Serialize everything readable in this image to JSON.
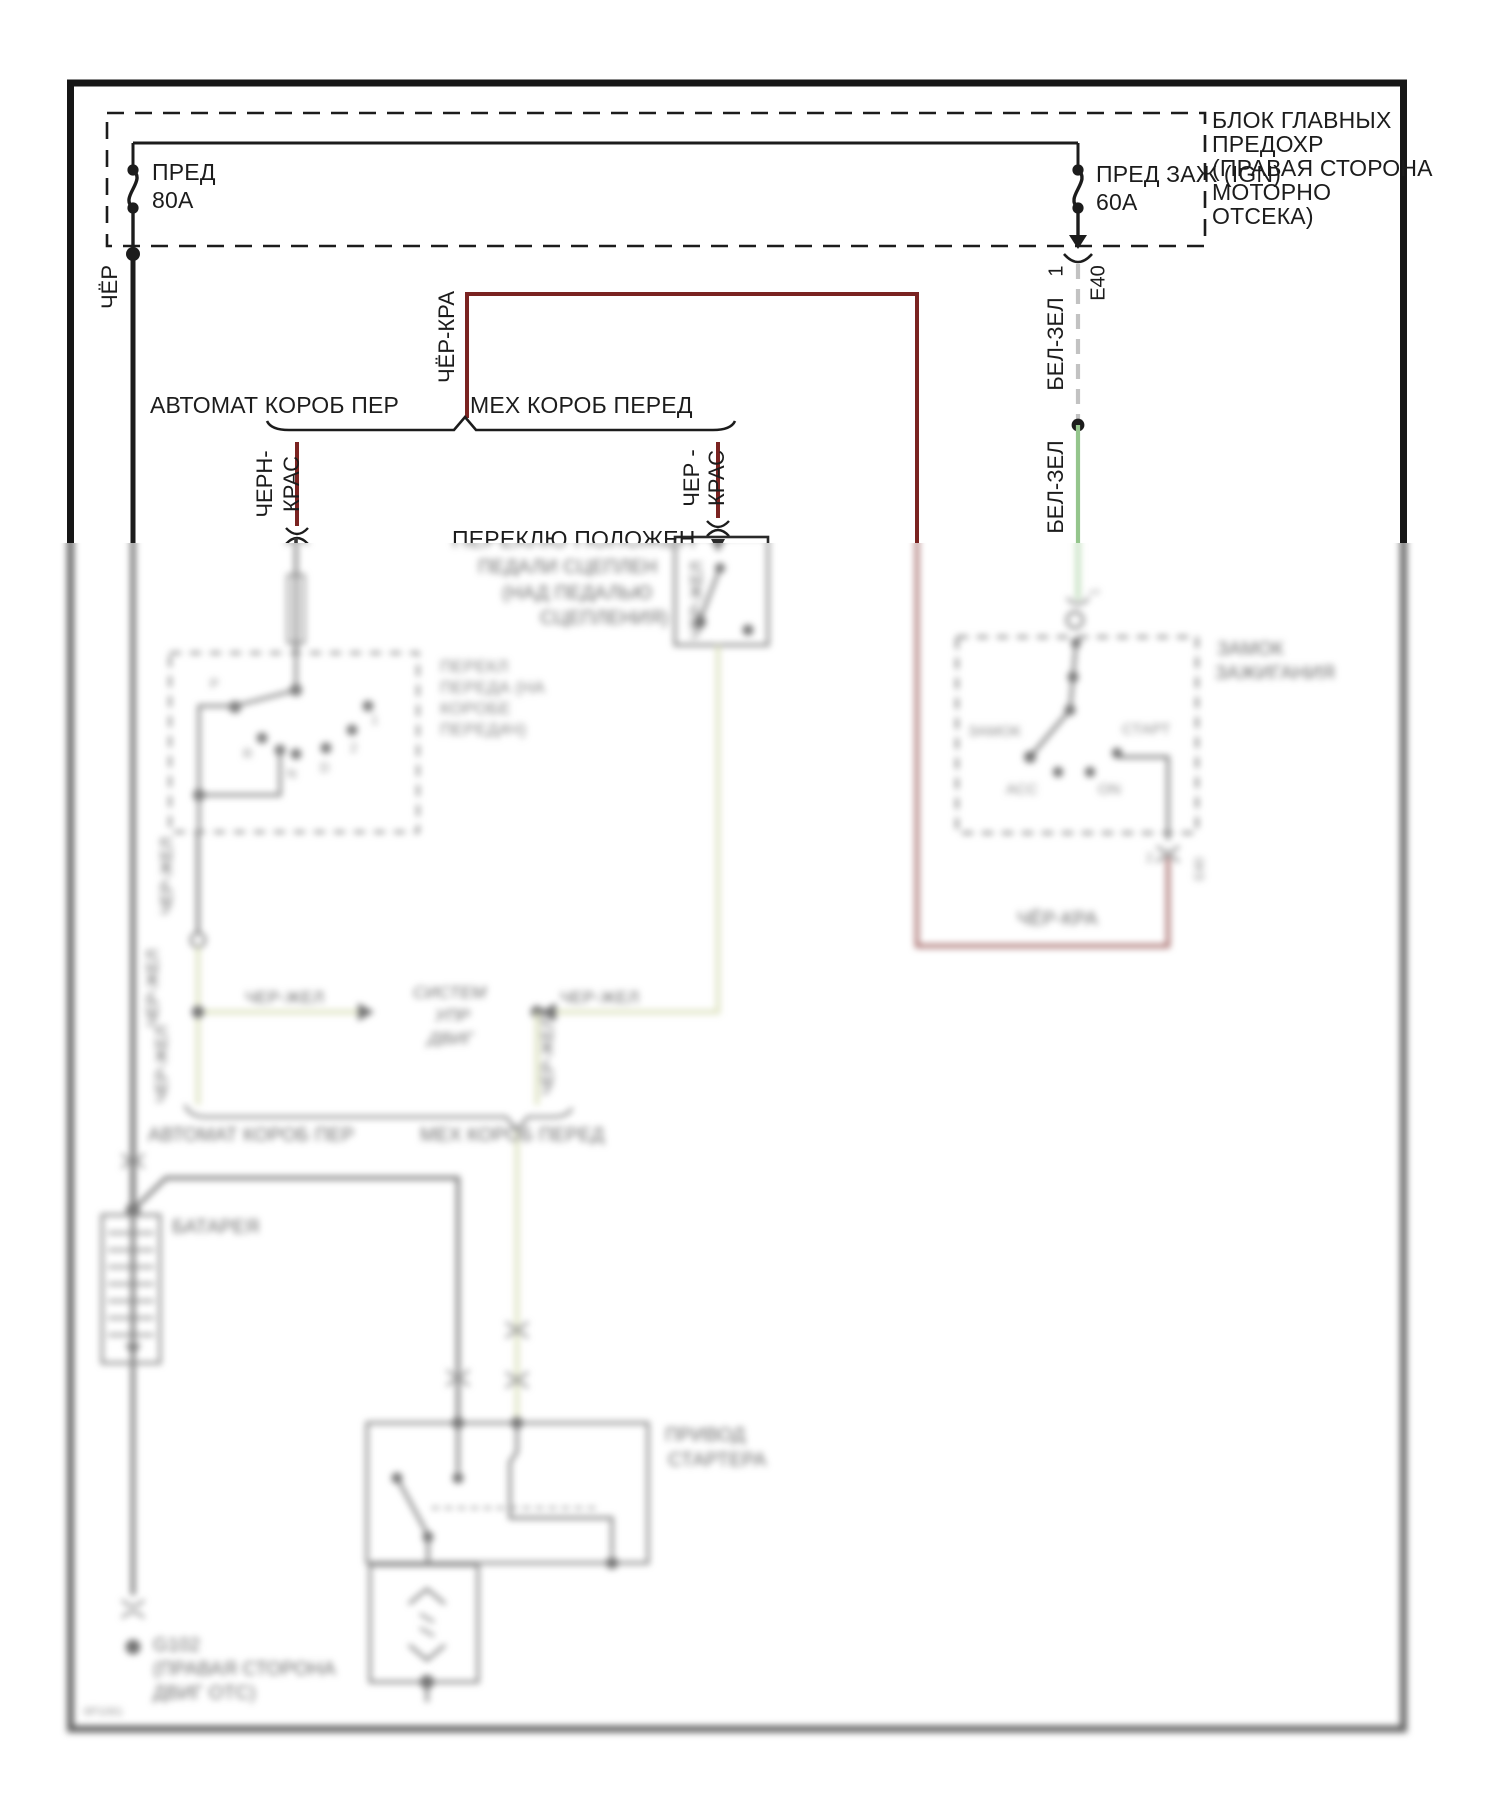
{
  "fuse_block": {
    "label_lines": [
      "БЛОК ГЛАВНЫХ",
      "ПРЕДОХР",
      "(ПРАВАЯ СТОРОНА",
      "МОТОРНО",
      "ОТСЕКА)"
    ],
    "fuse_left": {
      "name": "ПРЕД",
      "rating": "80А"
    },
    "fuse_right": {
      "name": "ПРЕД ЗАЖ (IGN)",
      "rating": "60А"
    }
  },
  "connector": {
    "pin_1": "1",
    "e40": "E40",
    "pin_2": "2"
  },
  "wires": {
    "cher": "ЧЁР",
    "cher_kra": "ЧЁР-КРА",
    "chern_kras_l1": "ЧЕРН-",
    "chern_kras_l2": "КРАС",
    "cher_kras_l1": "ЧЕР -",
    "cher_kras_l2": "КРАС",
    "bel_zel": "БЕЛ-ЗЕЛ",
    "cher_zhel": "ЧЕР-ЖЕЛ"
  },
  "sections": {
    "at": "АВТОМАТ КОРОБ ПЕР",
    "mt": "МЕХ КОРОБ ПЕРЕД"
  },
  "clutch_switch": {
    "lines": [
      "ПЕРЕКЛЮ ПОЛОЖЕН",
      "ПЕДАЛИ СЦЕПЛЕН",
      "(НАД ПЕДАЛЬЮ",
      "СЦЕПЛЕНИЯ)"
    ]
  },
  "range_switch": {
    "label_lines": [
      "ПЕРЕКЛ",
      "ПЕРЕДА (НА",
      "КОРОБЕ",
      "ПЕРЕДАЧ)"
    ],
    "positions": [
      "P",
      "R",
      "N",
      "D",
      "2",
      "1"
    ]
  },
  "ignition_switch": {
    "label_lines": [
      "ЗАМОК",
      "ЗАЖИГАНИЯ"
    ],
    "lock": "ЗАМОК",
    "acc": "АСС",
    "on": "ON",
    "start": "СТАРТ"
  },
  "ecm": {
    "lines": [
      "СИСТЕМ",
      "УПР",
      "ДВИГ"
    ]
  },
  "battery_label": "БАТАРЕЯ",
  "starter": {
    "lines": [
      "ПРИВОД",
      "СТАРТЕРА"
    ]
  },
  "ground": {
    "lines": [
      "G102",
      "(ПРАВАЯ СТОРОНА",
      "ДВИГ ОТС)"
    ]
  },
  "doc_code": "6P1061",
  "colors": {
    "wire_red": "#7a2321",
    "wire_green": "#94c58c",
    "wire_olive": "#cdd5a2",
    "wire_white_dash": "#c2c2c2",
    "line_black": "#1c1c1c"
  }
}
